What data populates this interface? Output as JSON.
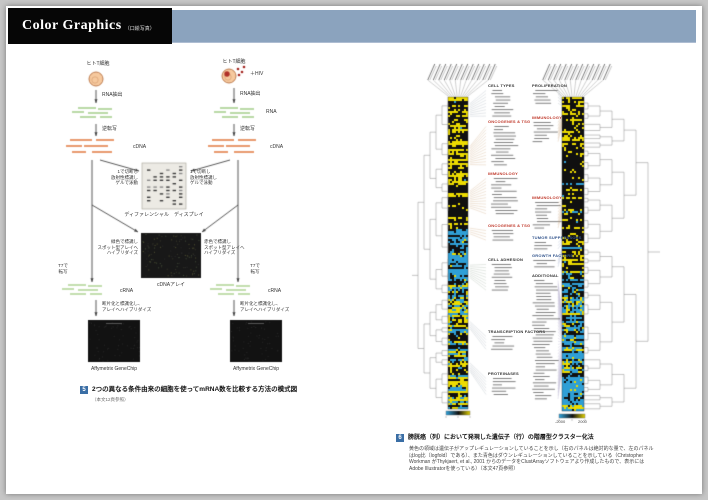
{
  "header": {
    "title": "Color Graphics",
    "subtitle": "（口絵写真）"
  },
  "colors": {
    "top_band": "#8ba3be",
    "page_background": "#ffffff",
    "desk_background": "#c6c6c6",
    "heatmap_upregulated_yellow": "#ecdb00",
    "heatmap_downregulated_blue": "#2f9fd6",
    "figure_number_blue": "#3a6ea5"
  },
  "left_figure": {
    "cell_label": "ヒトT細胞",
    "hiv_label": "＋HIV",
    "rna_extraction": "RNA抽出",
    "rna": "RNA",
    "reverse_transcription": "逆転写",
    "cdna": "cDNA",
    "cut_note": "1で切断し\n放射性標識し\nゲルで泳動",
    "differential_display": "ディファレンシャル　ディスプレイ",
    "green_note": "緑色で標識し\nスポット型アレイへ\nハイブリダイズ",
    "red_note": "赤色で標識し\nスポット型アレイへ\nハイブリダイズ",
    "cdna_array": "cDNAアレイ",
    "t7": "T7で\n転写",
    "crna": "cRNA",
    "frag_note": "断片化と標識化し、\nアレイへハイブリダイズ",
    "genechip": "Affymetrix GeneChip",
    "caption": {
      "num": "5",
      "title": "2つの異なる条件由来の細胞を使ってmRNA数を比較する方法の模式図",
      "ref": "（本文12頁参照）"
    }
  },
  "right_figure": {
    "categories": [
      {
        "col": 1,
        "label": "CELL TYPES",
        "color": "#333333",
        "y": 84,
        "n": 9
      },
      {
        "col": 1,
        "label": "ONCOGENES & TSG",
        "color": "#c0392b",
        "y": 120,
        "n": 13
      },
      {
        "col": 1,
        "label": "IMMUNOLOGY",
        "color": "#c0392b",
        "y": 172,
        "n": 12
      },
      {
        "col": 1,
        "label": "ONCOGENES & TSG",
        "color": "#c0392b",
        "y": 224,
        "n": 4
      },
      {
        "col": 1,
        "label": "CELL ADHESION",
        "color": "#333333",
        "y": 258,
        "n": 9
      },
      {
        "col": 1,
        "label": "TRANSCRIPTION FACTORS",
        "color": "#333333",
        "y": 330,
        "n": 5
      },
      {
        "col": 1,
        "label": "PROTEINASES",
        "color": "#333333",
        "y": 372,
        "n": 6
      },
      {
        "col": 2,
        "label": "PROLIFERATION",
        "color": "#333333",
        "y": 84,
        "n": 5
      },
      {
        "col": 2,
        "label": "IMMUNOLOGY",
        "color": "#c0392b",
        "y": 116,
        "n": 7
      },
      {
        "col": 2,
        "label": "IMMUNOLOGY",
        "color": "#c0392b",
        "y": 196,
        "n": 9
      },
      {
        "col": 2,
        "label": "TUMOR SUPPRESSORS",
        "color": "#33558d",
        "y": 236,
        "n": 3
      },
      {
        "col": 2,
        "label": "GROWTH FACTORS",
        "color": "#33558d",
        "y": 254,
        "n": 3
      },
      {
        "col": 2,
        "label": "ADDITIONAL",
        "color": "#333333",
        "y": 274,
        "n": 38
      }
    ],
    "scale": {
      "min": "-2000",
      "max": "2000"
    },
    "caption": {
      "num": "6",
      "title": "膀胱癌（列）において発現した遺伝子（行）の階層型クラスター化法",
      "lines": [
        "黄色の領域は遺伝子がアップレギュレーションしていることを示し（右のパネルは絶対的な量で、左のパネル",
        "はlog比〔logfold〕である）、また青色はダウンレギュレーションしていることを示している（Christopher",
        "Workman がThykjaert, et al., 2001 からのデータをClustArrayソフトウェアより作成したもので、表示には",
        "Adobe Illustratorを使っている）（本文47頁参照）"
      ]
    }
  }
}
